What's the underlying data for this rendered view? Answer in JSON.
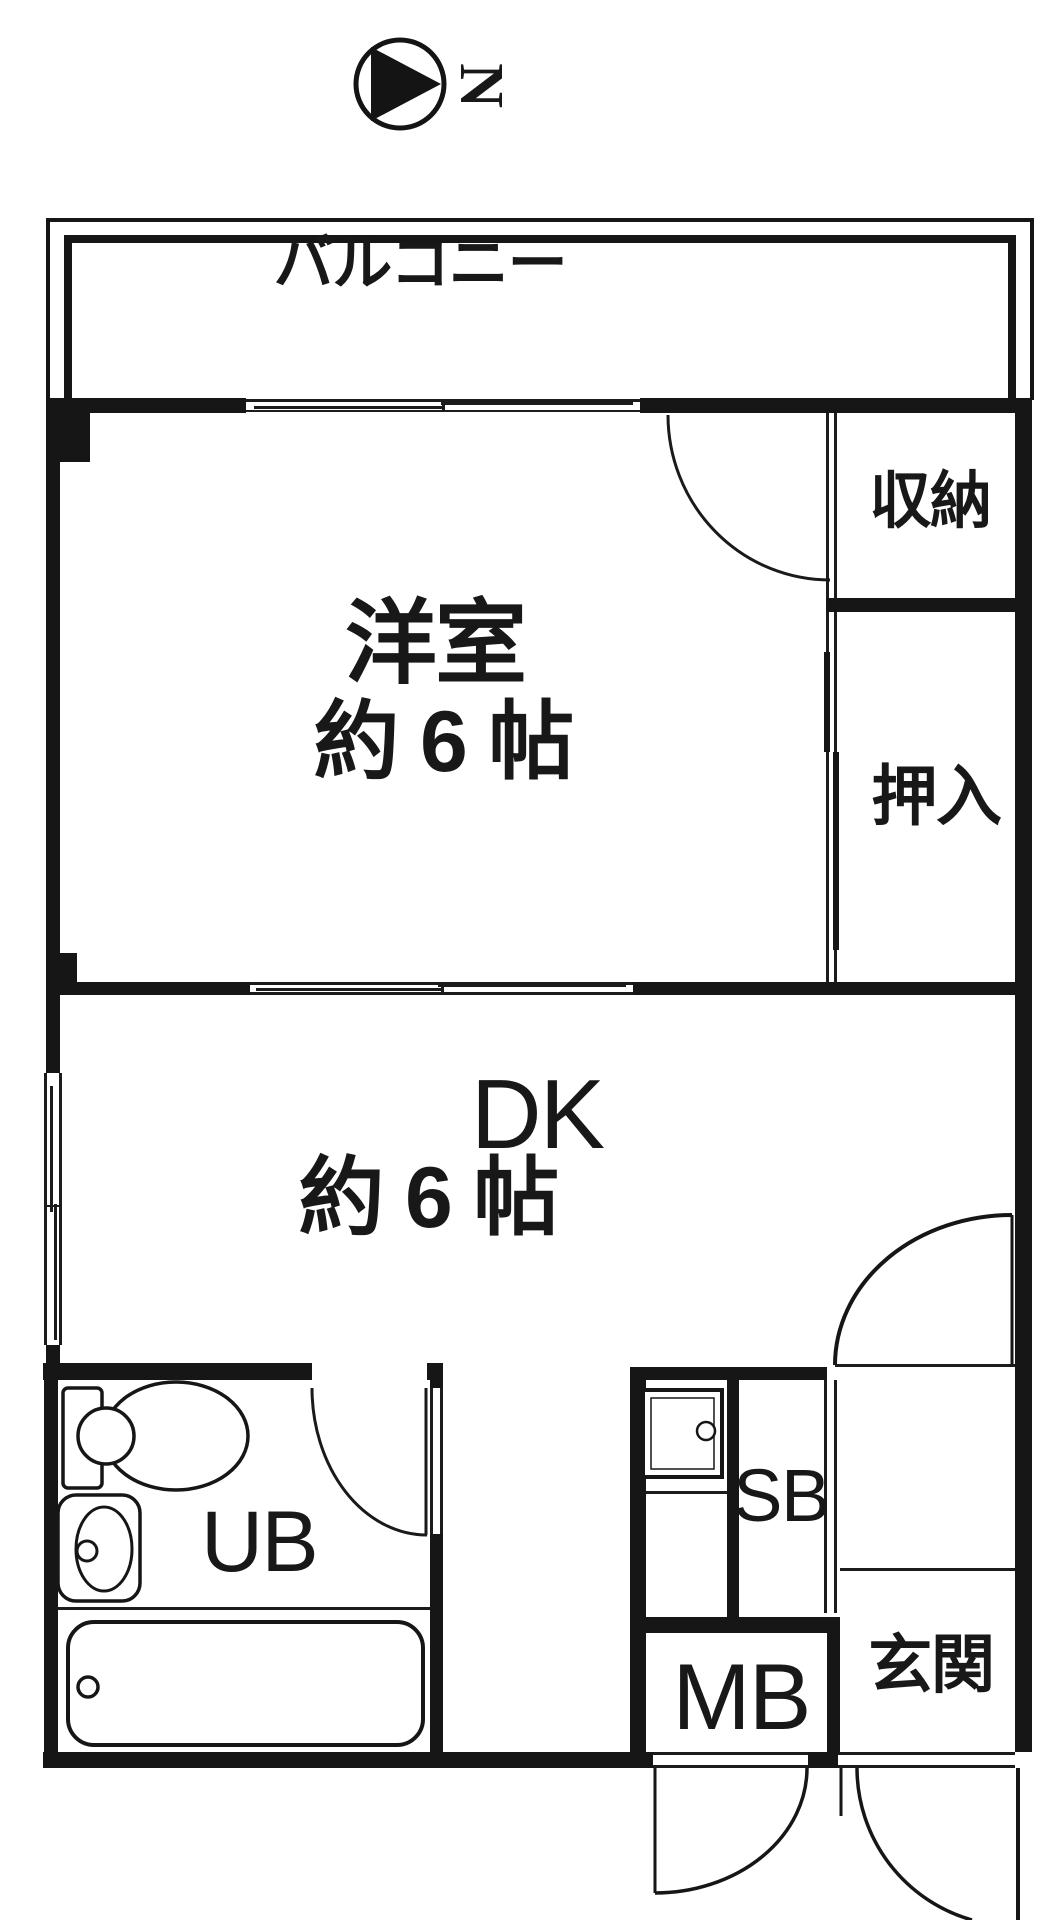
{
  "compass": {
    "north_label": "N"
  },
  "balcony": {
    "label": "バルコニー"
  },
  "western_room": {
    "label": "洋室",
    "size": "約 6 帖"
  },
  "storage": {
    "label": "収納"
  },
  "closet": {
    "label": "押入"
  },
  "dining_kitchen": {
    "label": "DK",
    "size": "約 6 帖"
  },
  "unit_bath": {
    "label": "UB"
  },
  "shoe_box": {
    "label": "SB"
  },
  "meter_box": {
    "label": "MB"
  },
  "entrance": {
    "label": "玄関"
  },
  "colors": {
    "line": "#161616",
    "background": "#ffffff"
  }
}
